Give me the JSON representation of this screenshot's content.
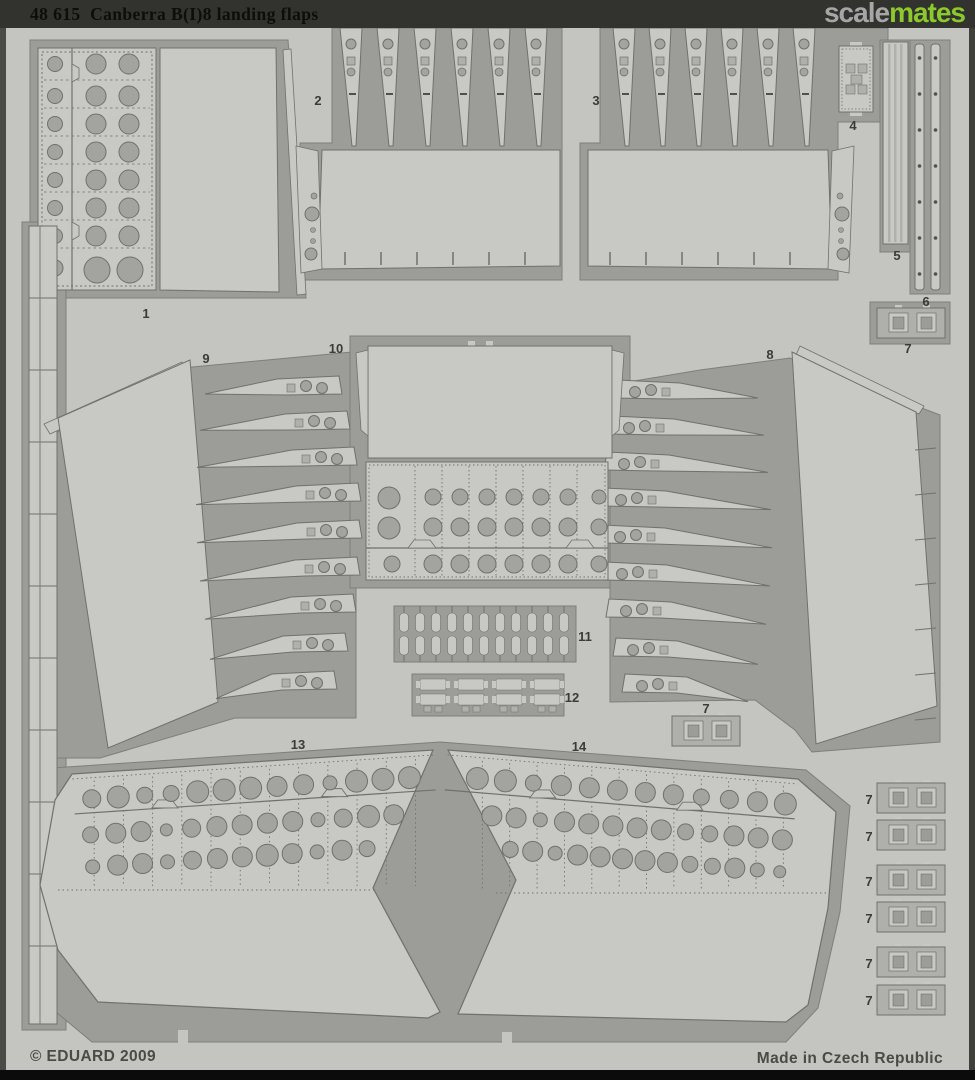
{
  "header": {
    "title": "48 615  Canberra B(I)8 landing flaps",
    "brand_gray": "scale",
    "brand_green": "mates"
  },
  "footer": {
    "copyright": "© EDUARD 2009",
    "origin": "Made in Czech Republic"
  },
  "colors": {
    "bar": "#32322e",
    "title": "#0d0d0b",
    "brand_gray_color": "#a6a6a6",
    "brand_green_color": "#8bc92c",
    "bottom_bar": "#0b0b0b",
    "footer_text": "#4a4a47",
    "sheet": "#c4c4c1",
    "etch": "#9c9c99",
    "etch_edge": "#7e7e7b",
    "part": "#c8c8c5",
    "part_mid": "#afafac",
    "hole": "#a3a3a0",
    "line": "#70706d",
    "dark": "#4f4f4c",
    "label": "#3b3b38",
    "edge_left": "#4a4a47",
    "edge_right": "#3f3f3c"
  },
  "part_labels": [
    {
      "n": "1",
      "x": 146,
      "y": 318
    },
    {
      "n": "2",
      "x": 318,
      "y": 105
    },
    {
      "n": "3",
      "x": 596,
      "y": 105
    },
    {
      "n": "4",
      "x": 853,
      "y": 130
    },
    {
      "n": "5",
      "x": 897,
      "y": 260
    },
    {
      "n": "6",
      "x": 926,
      "y": 306
    },
    {
      "n": "7",
      "x": 908,
      "y": 353
    },
    {
      "n": "8",
      "x": 770,
      "y": 359
    },
    {
      "n": "9",
      "x": 206,
      "y": 363
    },
    {
      "n": "10",
      "x": 336,
      "y": 353
    },
    {
      "n": "11",
      "x": 585,
      "y": 641
    },
    {
      "n": "12",
      "x": 572,
      "y": 702
    },
    {
      "n": "7",
      "x": 706,
      "y": 713
    },
    {
      "n": "13",
      "x": 298,
      "y": 749
    },
    {
      "n": "14",
      "x": 579,
      "y": 751
    },
    {
      "n": "7",
      "x": 869,
      "y": 804
    },
    {
      "n": "7",
      "x": 869,
      "y": 841
    },
    {
      "n": "7",
      "x": 869,
      "y": 886
    },
    {
      "n": "7",
      "x": 869,
      "y": 923
    },
    {
      "n": "7",
      "x": 869,
      "y": 968
    },
    {
      "n": "7",
      "x": 869,
      "y": 1005
    }
  ]
}
